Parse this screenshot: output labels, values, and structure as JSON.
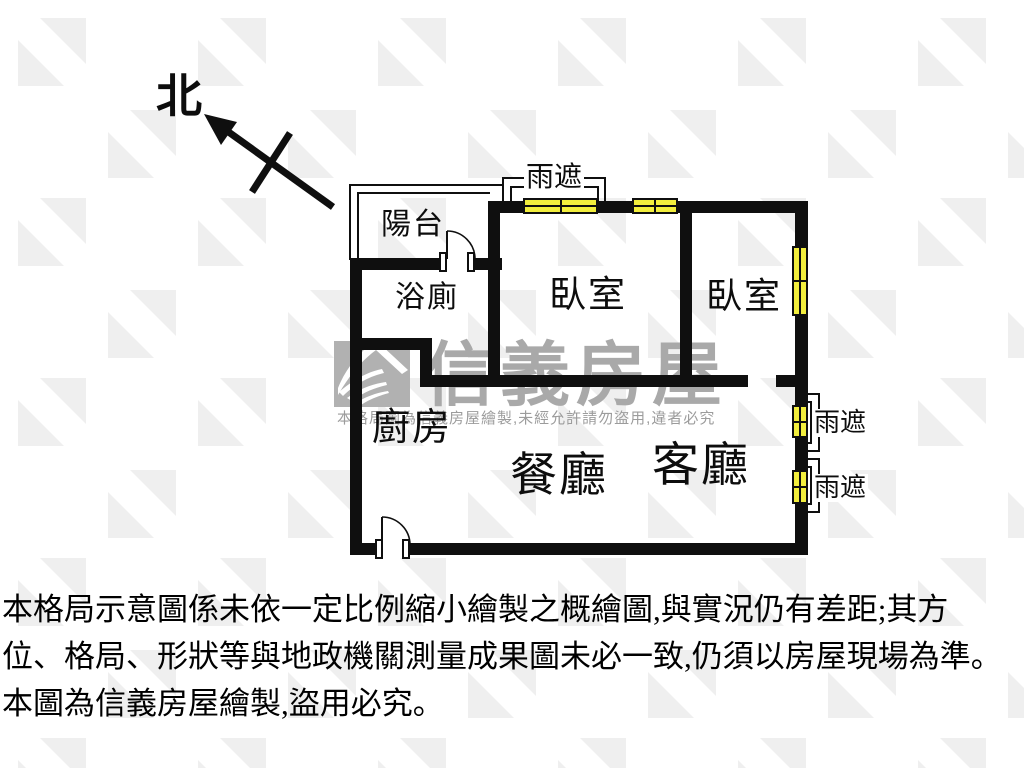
{
  "compass": {
    "label": "北"
  },
  "plan": {
    "balcony": "陽台",
    "bathroom": "浴廁",
    "bedroom1": "臥室",
    "bedroom2": "臥室",
    "kitchen": "廚房",
    "dining": "餐廳",
    "living": "客廳",
    "canopy_top": "雨遮",
    "canopy_right_upper": "雨遮",
    "canopy_right_lower": "雨遮"
  },
  "watermark": {
    "brand": "信義房屋",
    "notice": "本格局圖為信義房屋繪製,未經允許請勿盜用,違者必究"
  },
  "disclaimer": {
    "line1": "本格局示意圖係未依一定比例縮小繪製之概繪圖,與實況仍有差距;其方",
    "line2": "位、格局、形狀等與地政機關測量成果圖未必一致,仍須以房屋現場為準。",
    "line3": "本圖為信義房屋繪製,盜用必究。"
  },
  "colors": {
    "wall": "#0f0f0f",
    "window_fill": "#f2ee3d",
    "watermark_gray": "#a9a9a9"
  }
}
